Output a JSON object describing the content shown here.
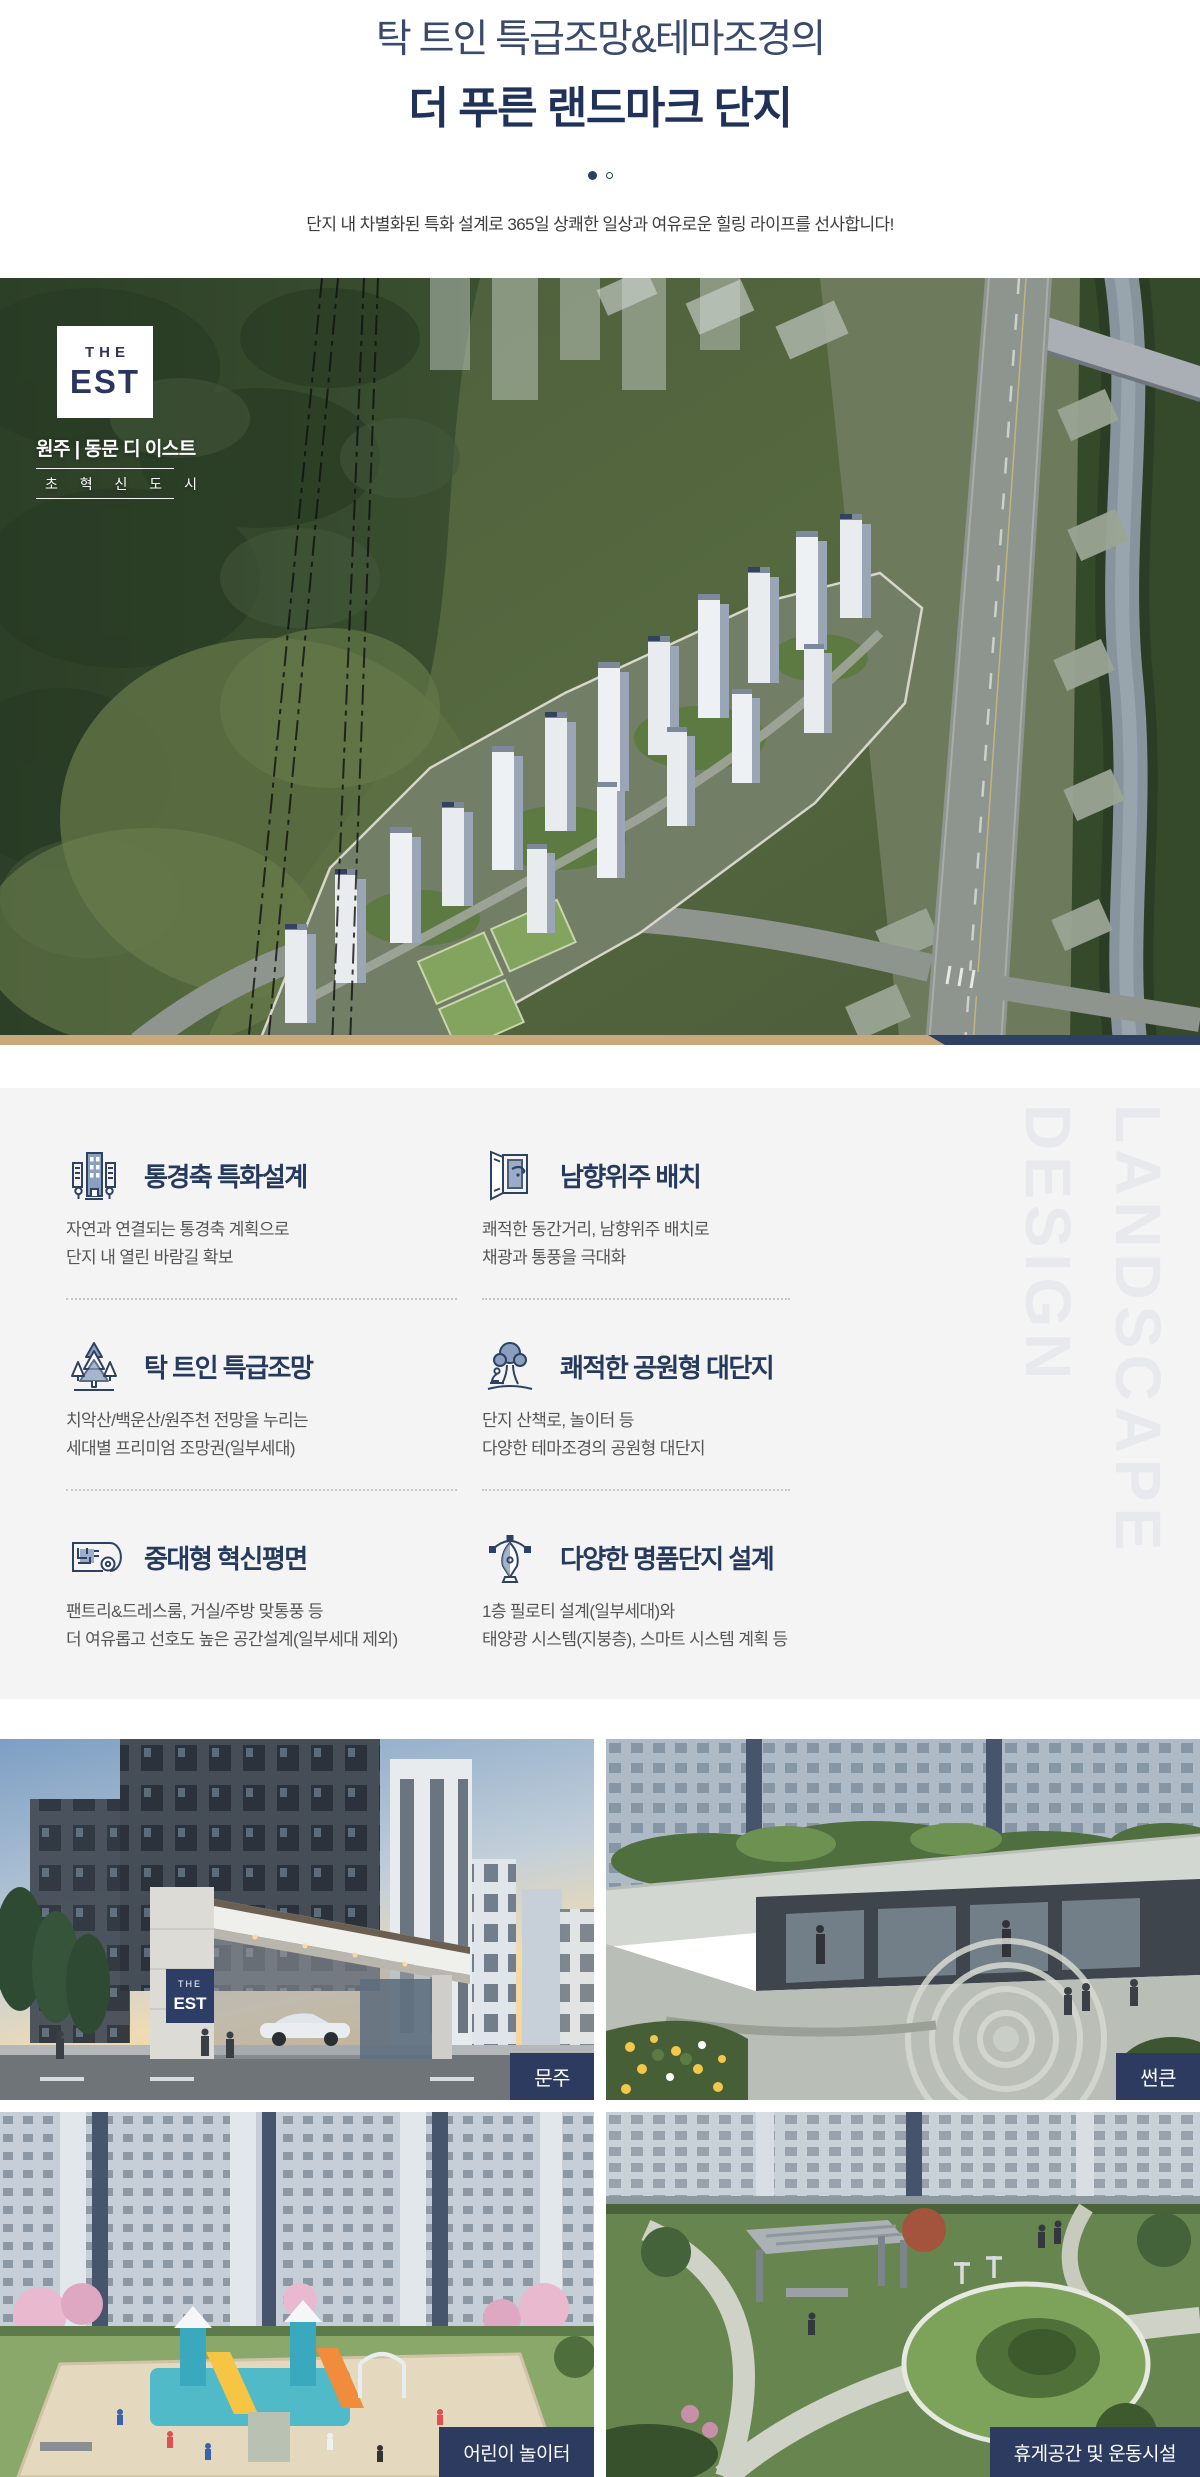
{
  "header": {
    "title_line1": "탁 트인 특급조망&테마조경의",
    "title_line2": "더 푸른 랜드마크 단지",
    "description": "단지 내 차별화된 특화 설계로 365일 상쾌한 일상과 여유로운 힐링 라이프를 선사합니다!",
    "pagination": {
      "total_dots": 2,
      "active_index": 0
    }
  },
  "aerial": {
    "brand": {
      "the": "THE",
      "est": "EST",
      "location": "원주 | 동문 디 이스트",
      "slogan": "초 혁 신 도 시"
    }
  },
  "features": {
    "watermark_line1": "DESIGN",
    "watermark_line2": "LANDSCAPE",
    "items": [
      {
        "icon": "view-axis-buildings-icon",
        "title": "통경축 특화설계",
        "desc1": "자연과 연결되는 통경축 계획으로",
        "desc2": "단지 내 열린 바람길 확보"
      },
      {
        "icon": "open-window-icon",
        "title": "남향위주 배치",
        "desc1": "쾌적한 동간거리, 남향위주 배치로",
        "desc2": "채광과 통풍을 극대화"
      },
      {
        "icon": "pine-trees-icon",
        "title": "탁 트인 특급조망",
        "desc1": "치악산/백운산/원주천 전망을 누리는",
        "desc2": "세대별 프리미엄 조망권(일부세대)"
      },
      {
        "icon": "park-tree-bench-icon",
        "title": "쾌적한 공원형 대단지",
        "desc1": "단지 산책로, 놀이터 등",
        "desc2": "다양한 테마조경의 공원형 대단지"
      },
      {
        "icon": "floorplan-scroll-icon",
        "title": "중대형 혁신평면",
        "desc1": "팬트리&드레스룸, 거실/주방 맞통풍 등",
        "desc2": "더 여유롭고 선호도 높은 공간설계(일부세대 제외)"
      },
      {
        "icon": "pen-nib-design-icon",
        "title": "다양한 명품단지 설계",
        "desc1": "1층 필로티 설계(일부세대)와",
        "desc2": "태양광 시스템(지붕층), 스마트 시스템 계획 등"
      }
    ]
  },
  "gallery": {
    "gate_sign": {
      "the": "THE",
      "est": "EST"
    },
    "items": [
      {
        "label": "문주"
      },
      {
        "label": "썬큰"
      },
      {
        "label": "어린이 놀이터"
      },
      {
        "label": "휴게공간 및 운동시설"
      }
    ]
  },
  "colors": {
    "navy": "#2c3b5f",
    "title_navy": "#20315a",
    "tan_bar": "#c9a87c",
    "section_bg": "#f4f4f5",
    "watermark": "#e8e9ec"
  }
}
